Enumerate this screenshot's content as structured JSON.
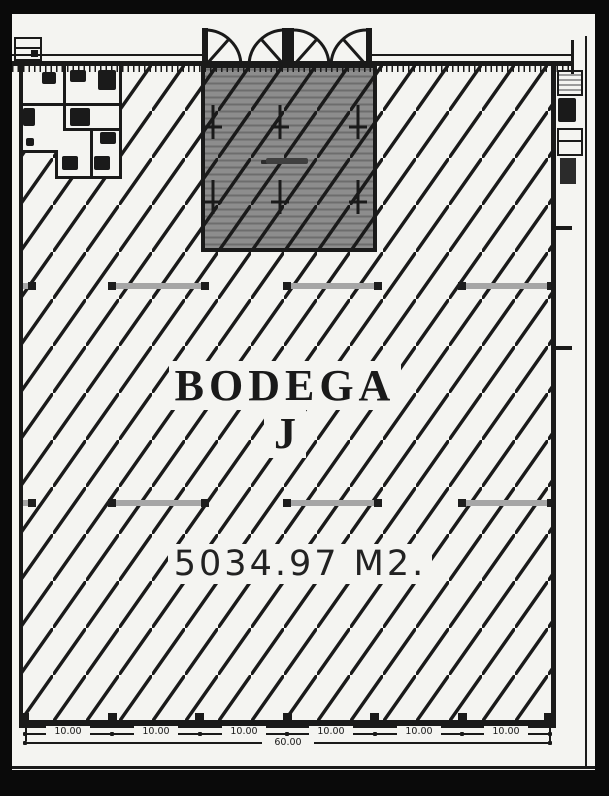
{
  "drawing": {
    "unit_name_line1": "BODEGA",
    "unit_name_line2": "J",
    "area_label": "5034.97 M2.",
    "dim_segments": [
      "10.00",
      "10.00",
      "10.00",
      "10.00",
      "10.00",
      "10.00"
    ],
    "dim_total": "60.00"
  },
  "colors": {
    "frame": "#0a0a0a",
    "page": "#f4f4f1",
    "ink": "#1a1a1a",
    "dock": "#8d8d8d",
    "dock_stripe": "#6d6d6d",
    "beam": "#a6a6a6"
  }
}
